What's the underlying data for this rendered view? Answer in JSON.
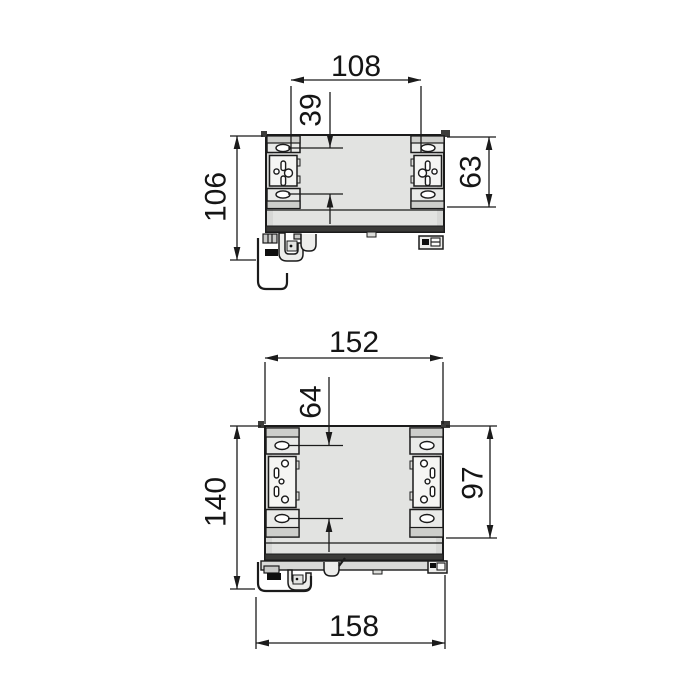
{
  "drawing": {
    "kind": "drawer-slide-mounting-dimension-drawing",
    "views": [
      {
        "name": "upper-view",
        "dims": {
          "mounting_slot_span": "108",
          "slot_vertical_spacing": "39",
          "overall_height": "106",
          "bracket_height": "63"
        }
      },
      {
        "name": "lower-view",
        "dims": {
          "body_width": "152",
          "slot_vertical_spacing": "64",
          "overall_height": "140",
          "bracket_height": "97",
          "overall_width": "158"
        }
      }
    ]
  },
  "colors": {
    "background": "#ffffff",
    "outline": "#1b1b1b",
    "body_fill": "#e2e3e1",
    "bracket_fill": "#e9eae8",
    "plate_fill": "#f5f5f3",
    "bar_fill": "#cdcecb",
    "dark_band": "#3a3a38",
    "dimension_text": "#151515"
  }
}
